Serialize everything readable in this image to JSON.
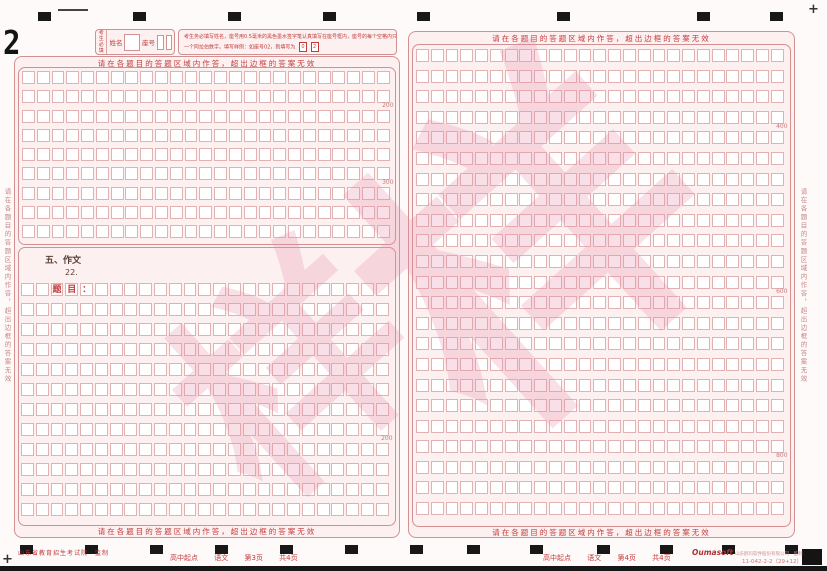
{
  "sheet_sequence_number": "2",
  "region_notice": "请在各题目的答题区域内作答，超出边框的答案无效",
  "student_info": {
    "must_fill_line1": "考生",
    "must_fill_line2": "必填",
    "name_label": "姓名",
    "seat_label": "座号",
    "instructions_line1": "考生务必填写姓名，座号用0.5毫米的黑色墨水签字笔认真填写在座号框内，座号的每个空格内只能填写",
    "instructions_line2": "一个阿拉伯数字。填写样例：如座号02，则填写为",
    "sample_digit_1": "0",
    "sample_digit_2": "2"
  },
  "left_page": {
    "answer_grid": {
      "rows": 9,
      "cols": 25,
      "markers": [
        {
          "after_row": 2,
          "count": "200"
        },
        {
          "after_row": 6,
          "count": "300"
        }
      ]
    },
    "essay_section": {
      "title": "五、作文",
      "question_number": "22.",
      "grid": {
        "rows": 12,
        "cols": 25,
        "prefilled": [
          {
            "row": 1,
            "col": 3,
            "char": "题"
          },
          {
            "row": 1,
            "col": 4,
            "char": "目"
          },
          {
            "row": 1,
            "col": 5,
            "char": "："
          }
        ],
        "markers": [
          {
            "after_row": 8,
            "count": "200"
          }
        ]
      }
    },
    "footer": {
      "course": "高中起点",
      "subject": "语文",
      "page": "第3页",
      "total": "共4页"
    }
  },
  "right_page": {
    "essay_grid": {
      "rows": 23,
      "cols": 25,
      "markers": [
        {
          "after_row": 4,
          "count": "400"
        },
        {
          "after_row": 12,
          "count": "600"
        },
        {
          "after_row": 20,
          "count": "800"
        }
      ]
    },
    "footer": {
      "course": "高中起点",
      "subject": "语文",
      "page": "第4页",
      "total": "共4页"
    }
  },
  "footer": {
    "issuer": "山东省教育招生考试院　监制",
    "logo": "Oumasoft",
    "company": "山东鸥玛软件股份有限公司　监制",
    "code": "11-042-2-2（29+12）"
  },
  "watermark_char": "样",
  "registration": {
    "plus": "+"
  },
  "colors": {
    "accent_red": "#c23b3b",
    "grid_pink": "#e2b2b2",
    "border_pink": "#d29090",
    "watermark_pink": "#e98caa",
    "mark_black": "#181818"
  }
}
